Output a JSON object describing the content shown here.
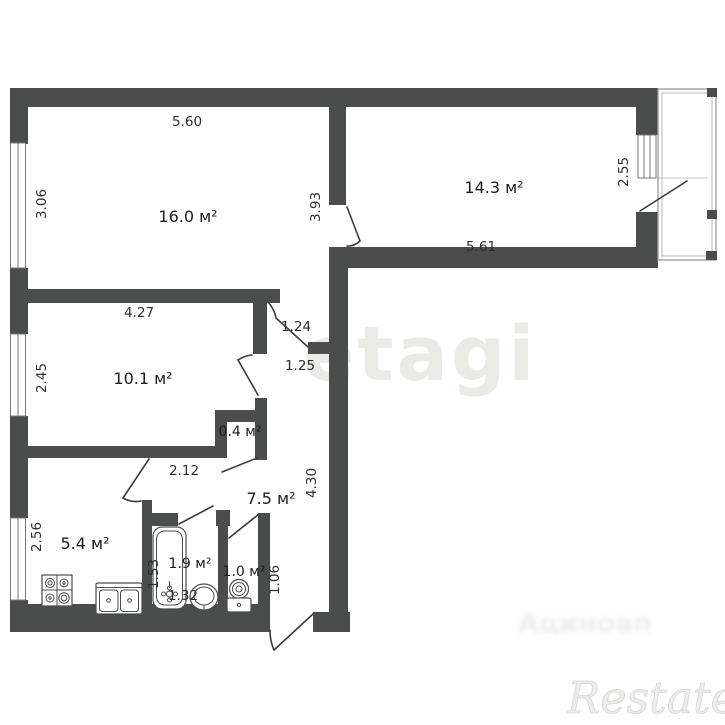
{
  "colors": {
    "wall": "#4a4d4c",
    "background": "#ffffff",
    "dimension_text": "#2d2f2e",
    "watermark_gray": "#eaeae7"
  },
  "rooms": [
    {
      "name": "living-room",
      "area_label": "16.0 м²"
    },
    {
      "name": "bedroom",
      "area_label": "14.3 м²"
    },
    {
      "name": "room-second",
      "area_label": "10.1 м²"
    },
    {
      "name": "storage",
      "area_label": "0.4 м²"
    },
    {
      "name": "hallway",
      "area_label": "7.5 м²"
    },
    {
      "name": "kitchen",
      "area_label": "5.4 м²"
    },
    {
      "name": "bathroom",
      "area_label": "1.9 м²"
    },
    {
      "name": "wc",
      "area_label": "1.0 м²"
    }
  ],
  "dimension_labels": [
    {
      "value": "5.60"
    },
    {
      "value": "3.06"
    },
    {
      "value": "3.93"
    },
    {
      "value": "5.61"
    },
    {
      "value": "2.55"
    },
    {
      "value": "4.27"
    },
    {
      "value": "2.45"
    },
    {
      "value": "1.24"
    },
    {
      "value": "1.25"
    },
    {
      "value": "2.12"
    },
    {
      "value": "4.30"
    },
    {
      "value": "2.56"
    },
    {
      "value": "1.53"
    },
    {
      "value": "1.32"
    },
    {
      "value": "1.06"
    }
  ],
  "icons": [
    {
      "name": "stove-icon"
    },
    {
      "name": "kitchen-sink-icon"
    },
    {
      "name": "bathtub-icon"
    },
    {
      "name": "washbasin-icon"
    },
    {
      "name": "toilet-icon"
    },
    {
      "name": "window-symbol"
    },
    {
      "name": "door-swing-symbol"
    },
    {
      "name": "balcony-railing"
    }
  ],
  "watermarks": {
    "brand_center": "etagi",
    "brand_bottom_right": "Restate",
    "blurred_text": "Ациноап"
  }
}
